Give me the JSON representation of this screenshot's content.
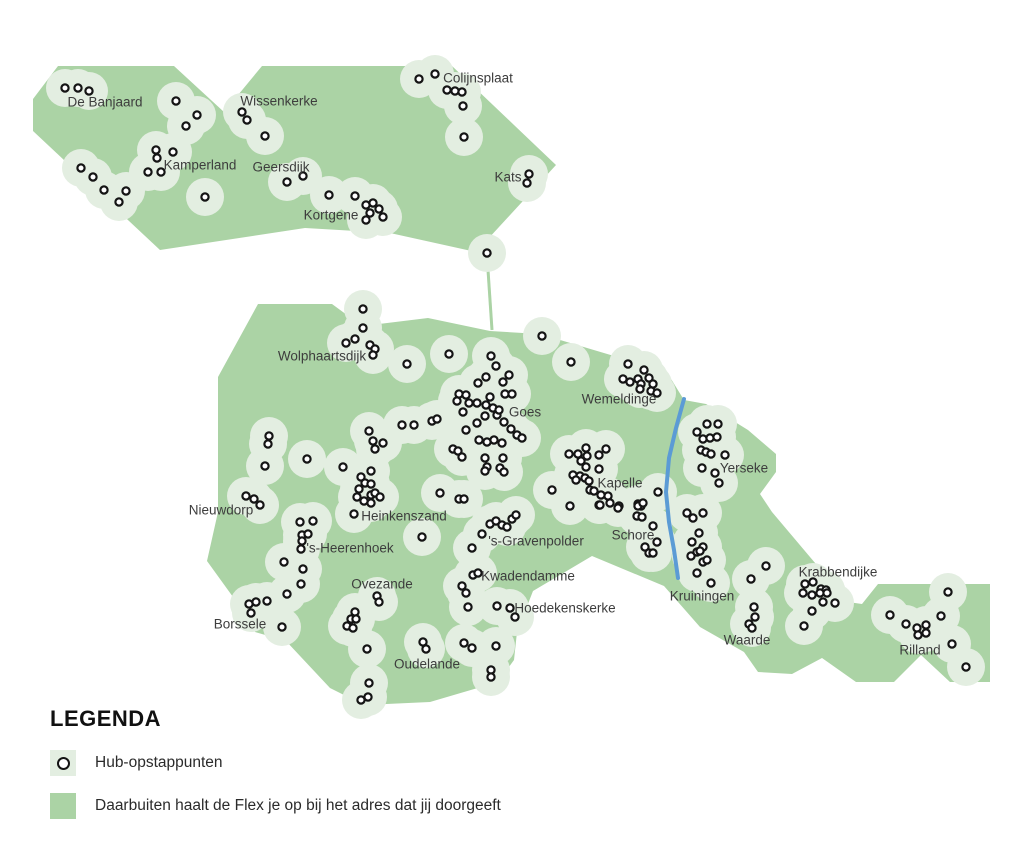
{
  "colors": {
    "land": "#abd3a5",
    "halo": "#e3eee1",
    "river": "#5b9bd5",
    "dot_fill": "#ffffff",
    "dot_stroke": "#141414",
    "label": "#3d3d3d"
  },
  "map": {
    "width": 1024,
    "height": 854,
    "halo_radius": 19,
    "hub_radius": 3.6,
    "hub_stroke_width": 2.2,
    "land_polygons": [
      {
        "name": "noord-beveland",
        "points": [
          [
            58,
            66
          ],
          [
            174,
            66
          ],
          [
            224,
            112
          ],
          [
            262,
            66
          ],
          [
            452,
            66
          ],
          [
            556,
            165
          ],
          [
            476,
            252
          ],
          [
            390,
            233
          ],
          [
            305,
            228
          ],
          [
            160,
            250
          ],
          [
            33,
            131
          ],
          [
            33,
            99
          ]
        ]
      },
      {
        "name": "zuid-beveland",
        "points": [
          [
            258,
            304
          ],
          [
            332,
            304
          ],
          [
            362,
            326
          ],
          [
            428,
            318
          ],
          [
            490,
            331
          ],
          [
            540,
            334
          ],
          [
            614,
            356
          ],
          [
            668,
            374
          ],
          [
            684,
            400
          ],
          [
            706,
            404
          ],
          [
            748,
            430
          ],
          [
            776,
            454
          ],
          [
            776,
            472
          ],
          [
            760,
            494
          ],
          [
            772,
            512
          ],
          [
            848,
            602
          ],
          [
            862,
            604
          ],
          [
            878,
            584
          ],
          [
            990,
            584
          ],
          [
            990,
            682
          ],
          [
            950,
            682
          ],
          [
            921,
            655
          ],
          [
            894,
            682
          ],
          [
            856,
            682
          ],
          [
            822,
            658
          ],
          [
            792,
            674
          ],
          [
            758,
            672
          ],
          [
            744,
            652
          ],
          [
            700,
            627
          ],
          [
            664,
            586
          ],
          [
            592,
            556
          ],
          [
            533,
            591
          ],
          [
            517,
            632
          ],
          [
            514,
            660
          ],
          [
            498,
            682
          ],
          [
            430,
            702
          ],
          [
            364,
            705
          ],
          [
            330,
            688
          ],
          [
            286,
            641
          ],
          [
            255,
            632
          ],
          [
            233,
            597
          ],
          [
            207,
            561
          ],
          [
            218,
            512
          ],
          [
            218,
            377
          ]
        ]
      }
    ],
    "ferry_line": [
      [
        487,
        255
      ],
      [
        492,
        330
      ]
    ],
    "river": [
      [
        684,
        399
      ],
      [
        676,
        428
      ],
      [
        669,
        458
      ],
      [
        666,
        492
      ],
      [
        669,
        522
      ],
      [
        674,
        550
      ],
      [
        678,
        578
      ]
    ],
    "hubs": [
      [
        65,
        88
      ],
      [
        78,
        88
      ],
      [
        89,
        91
      ],
      [
        176,
        101
      ],
      [
        197,
        115
      ],
      [
        186,
        126
      ],
      [
        242,
        112
      ],
      [
        247,
        120
      ],
      [
        265,
        136
      ],
      [
        156,
        150
      ],
      [
        173,
        152
      ],
      [
        157,
        158
      ],
      [
        148,
        172
      ],
      [
        161,
        172
      ],
      [
        81,
        168
      ],
      [
        93,
        177
      ],
      [
        104,
        190
      ],
      [
        119,
        202
      ],
      [
        126,
        191
      ],
      [
        205,
        197
      ],
      [
        287,
        182
      ],
      [
        303,
        176
      ],
      [
        329,
        195
      ],
      [
        355,
        196
      ],
      [
        366,
        205
      ],
      [
        373,
        203
      ],
      [
        379,
        209
      ],
      [
        370,
        213
      ],
      [
        366,
        220
      ],
      [
        383,
        217
      ],
      [
        419,
        79
      ],
      [
        435,
        74
      ],
      [
        447,
        90
      ],
      [
        455,
        91
      ],
      [
        462,
        92
      ],
      [
        463,
        106
      ],
      [
        464,
        137
      ],
      [
        529,
        174
      ],
      [
        527,
        183
      ],
      [
        487,
        253
      ],
      [
        363,
        309
      ],
      [
        363,
        328
      ],
      [
        346,
        343
      ],
      [
        355,
        339
      ],
      [
        370,
        345
      ],
      [
        375,
        349
      ],
      [
        373,
        355
      ],
      [
        407,
        364
      ],
      [
        449,
        354
      ],
      [
        542,
        336
      ],
      [
        571,
        362
      ],
      [
        491,
        356
      ],
      [
        496,
        366
      ],
      [
        486,
        377
      ],
      [
        478,
        383
      ],
      [
        509,
        375
      ],
      [
        503,
        382
      ],
      [
        459,
        394
      ],
      [
        466,
        395
      ],
      [
        457,
        401
      ],
      [
        469,
        403
      ],
      [
        477,
        403
      ],
      [
        463,
        412
      ],
      [
        486,
        405
      ],
      [
        490,
        397
      ],
      [
        493,
        408
      ],
      [
        485,
        416
      ],
      [
        497,
        415
      ],
      [
        499,
        410
      ],
      [
        505,
        394
      ],
      [
        512,
        394
      ],
      [
        504,
        422
      ],
      [
        511,
        429
      ],
      [
        477,
        423
      ],
      [
        466,
        430
      ],
      [
        479,
        440
      ],
      [
        487,
        442
      ],
      [
        494,
        440
      ],
      [
        502,
        443
      ],
      [
        517,
        435
      ],
      [
        522,
        438
      ],
      [
        453,
        449
      ],
      [
        458,
        451
      ],
      [
        462,
        457
      ],
      [
        485,
        458
      ],
      [
        487,
        467
      ],
      [
        485,
        471
      ],
      [
        503,
        458
      ],
      [
        500,
        468
      ],
      [
        504,
        472
      ],
      [
        440,
        493
      ],
      [
        459,
        499
      ],
      [
        464,
        499
      ],
      [
        402,
        425
      ],
      [
        414,
        425
      ],
      [
        432,
        421
      ],
      [
        437,
        419
      ],
      [
        369,
        431
      ],
      [
        373,
        441
      ],
      [
        383,
        443
      ],
      [
        375,
        449
      ],
      [
        269,
        436
      ],
      [
        268,
        444
      ],
      [
        265,
        466
      ],
      [
        307,
        459
      ],
      [
        343,
        467
      ],
      [
        246,
        496
      ],
      [
        254,
        499
      ],
      [
        260,
        505
      ],
      [
        371,
        471
      ],
      [
        361,
        477
      ],
      [
        365,
        483
      ],
      [
        359,
        489
      ],
      [
        371,
        484
      ],
      [
        357,
        497
      ],
      [
        364,
        501
      ],
      [
        371,
        495
      ],
      [
        375,
        493
      ],
      [
        380,
        497
      ],
      [
        371,
        503
      ],
      [
        354,
        514
      ],
      [
        422,
        537
      ],
      [
        300,
        522
      ],
      [
        313,
        521
      ],
      [
        302,
        535
      ],
      [
        308,
        534
      ],
      [
        302,
        541
      ],
      [
        301,
        549
      ],
      [
        284,
        562
      ],
      [
        303,
        569
      ],
      [
        301,
        584
      ],
      [
        287,
        594
      ],
      [
        249,
        604
      ],
      [
        256,
        602
      ],
      [
        251,
        613
      ],
      [
        267,
        601
      ],
      [
        282,
        627
      ],
      [
        377,
        596
      ],
      [
        379,
        602
      ],
      [
        355,
        612
      ],
      [
        351,
        619
      ],
      [
        356,
        619
      ],
      [
        347,
        626
      ],
      [
        353,
        628
      ],
      [
        367,
        649
      ],
      [
        423,
        642
      ],
      [
        426,
        649
      ],
      [
        369,
        683
      ],
      [
        361,
        700
      ],
      [
        368,
        697
      ],
      [
        490,
        524
      ],
      [
        496,
        521
      ],
      [
        502,
        525
      ],
      [
        512,
        519
      ],
      [
        516,
        515
      ],
      [
        507,
        527
      ],
      [
        482,
        534
      ],
      [
        472,
        548
      ],
      [
        552,
        490
      ],
      [
        570,
        506
      ],
      [
        599,
        505
      ],
      [
        610,
        503
      ],
      [
        473,
        575
      ],
      [
        478,
        573
      ],
      [
        462,
        586
      ],
      [
        466,
        593
      ],
      [
        468,
        607
      ],
      [
        497,
        606
      ],
      [
        510,
        608
      ],
      [
        515,
        617
      ],
      [
        464,
        643
      ],
      [
        472,
        648
      ],
      [
        496,
        646
      ],
      [
        491,
        670
      ],
      [
        491,
        677
      ],
      [
        569,
        454
      ],
      [
        578,
        454
      ],
      [
        586,
        448
      ],
      [
        587,
        456
      ],
      [
        581,
        461
      ],
      [
        599,
        455
      ],
      [
        606,
        449
      ],
      [
        586,
        467
      ],
      [
        599,
        469
      ],
      [
        573,
        475
      ],
      [
        580,
        476
      ],
      [
        585,
        478
      ],
      [
        589,
        481
      ],
      [
        576,
        480
      ],
      [
        590,
        490
      ],
      [
        594,
        491
      ],
      [
        608,
        496
      ],
      [
        619,
        506
      ],
      [
        638,
        504
      ],
      [
        641,
        506
      ],
      [
        658,
        492
      ],
      [
        628,
        364
      ],
      [
        644,
        370
      ],
      [
        623,
        379
      ],
      [
        630,
        382
      ],
      [
        638,
        379
      ],
      [
        649,
        378
      ],
      [
        641,
        384
      ],
      [
        653,
        384
      ],
      [
        640,
        389
      ],
      [
        651,
        391
      ],
      [
        657,
        393
      ],
      [
        707,
        424
      ],
      [
        718,
        424
      ],
      [
        697,
        432
      ],
      [
        703,
        439
      ],
      [
        710,
        438
      ],
      [
        717,
        437
      ],
      [
        701,
        450
      ],
      [
        706,
        452
      ],
      [
        711,
        454
      ],
      [
        725,
        455
      ],
      [
        702,
        468
      ],
      [
        715,
        473
      ],
      [
        719,
        483
      ],
      [
        601,
        495
      ],
      [
        600,
        505
      ],
      [
        618,
        508
      ],
      [
        638,
        506
      ],
      [
        643,
        503
      ],
      [
        637,
        516
      ],
      [
        642,
        517
      ],
      [
        653,
        526
      ],
      [
        657,
        542
      ],
      [
        645,
        547
      ],
      [
        649,
        553
      ],
      [
        653,
        553
      ],
      [
        687,
        513
      ],
      [
        693,
        518
      ],
      [
        703,
        513
      ],
      [
        699,
        533
      ],
      [
        692,
        542
      ],
      [
        703,
        547
      ],
      [
        691,
        556
      ],
      [
        697,
        552
      ],
      [
        700,
        551
      ],
      [
        703,
        562
      ],
      [
        707,
        560
      ],
      [
        697,
        573
      ],
      [
        711,
        583
      ],
      [
        766,
        566
      ],
      [
        751,
        579
      ],
      [
        754,
        607
      ],
      [
        755,
        617
      ],
      [
        749,
        624
      ],
      [
        752,
        628
      ],
      [
        805,
        584
      ],
      [
        813,
        582
      ],
      [
        821,
        589
      ],
      [
        826,
        590
      ],
      [
        803,
        593
      ],
      [
        812,
        595
      ],
      [
        820,
        593
      ],
      [
        827,
        593
      ],
      [
        823,
        602
      ],
      [
        835,
        603
      ],
      [
        812,
        611
      ],
      [
        804,
        626
      ],
      [
        948,
        592
      ],
      [
        890,
        615
      ],
      [
        906,
        624
      ],
      [
        941,
        616
      ],
      [
        917,
        628
      ],
      [
        926,
        625
      ],
      [
        918,
        635
      ],
      [
        926,
        633
      ],
      [
        952,
        644
      ],
      [
        966,
        667
      ]
    ],
    "towns": [
      {
        "name": "De Banjaard",
        "x": 105,
        "y": 102
      },
      {
        "name": "Wissenkerke",
        "x": 279,
        "y": 101
      },
      {
        "name": "Kamperland",
        "x": 200,
        "y": 165
      },
      {
        "name": "Geersdijk",
        "x": 281,
        "y": 167
      },
      {
        "name": "Kortgene",
        "x": 331,
        "y": 215
      },
      {
        "name": "Colijnsplaat",
        "x": 478,
        "y": 78
      },
      {
        "name": "Kats",
        "x": 508,
        "y": 177
      },
      {
        "name": "Wolphaartsdijk",
        "x": 322,
        "y": 356
      },
      {
        "name": "Goes",
        "x": 525,
        "y": 412
      },
      {
        "name": "Wemeldinge",
        "x": 619,
        "y": 399
      },
      {
        "name": "Yerseke",
        "x": 744,
        "y": 468
      },
      {
        "name": "Kapelle",
        "x": 620,
        "y": 483
      },
      {
        "name": "Nieuwdorp",
        "x": 221,
        "y": 510
      },
      {
        "name": "Heinkenszand",
        "x": 404,
        "y": 516
      },
      {
        "name": "'s-Heerenhoek",
        "x": 350,
        "y": 548
      },
      {
        "name": "'s-Gravenpolder",
        "x": 536,
        "y": 541
      },
      {
        "name": "Schore",
        "x": 633,
        "y": 535
      },
      {
        "name": "Kwadendamme",
        "x": 528,
        "y": 576
      },
      {
        "name": "Ovezande",
        "x": 382,
        "y": 584
      },
      {
        "name": "Kruiningen",
        "x": 702,
        "y": 596
      },
      {
        "name": "Krabbendijke",
        "x": 838,
        "y": 572
      },
      {
        "name": "Borssele",
        "x": 240,
        "y": 624
      },
      {
        "name": "Hoedekenskerke",
        "x": 565,
        "y": 608
      },
      {
        "name": "Waarde",
        "x": 747,
        "y": 640
      },
      {
        "name": "Oudelande",
        "x": 427,
        "y": 664
      },
      {
        "name": "Rilland",
        "x": 920,
        "y": 650
      }
    ]
  },
  "legend": {
    "title": "LEGENDA",
    "items": [
      {
        "swatch": "hub",
        "label": "Hub-opstappunten"
      },
      {
        "swatch": "area",
        "label": "Daarbuiten haalt de Flex je op bij het adres dat jij doorgeeft"
      }
    ]
  }
}
